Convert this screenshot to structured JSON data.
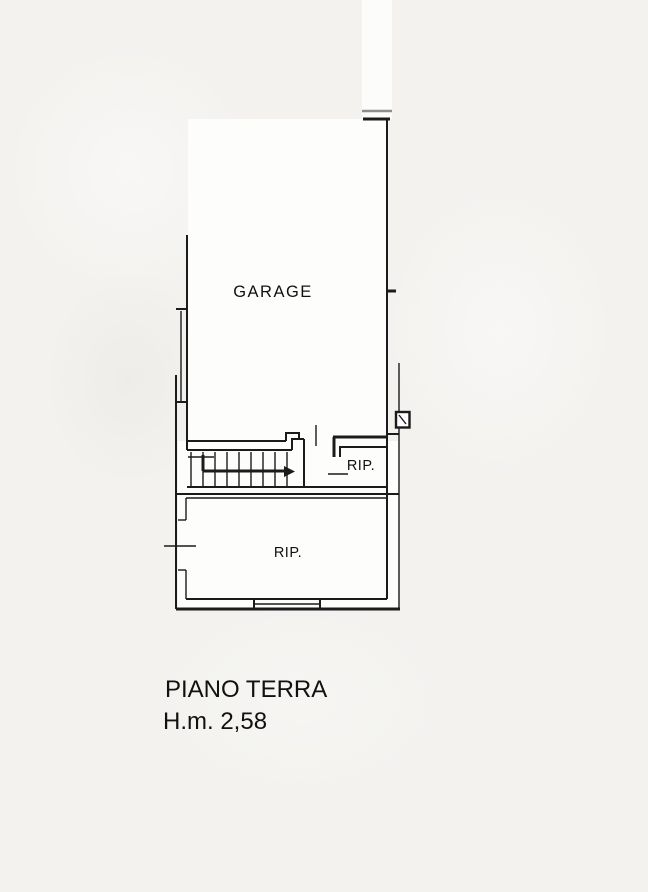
{
  "title_block": {
    "floor_name": "PIANO TERRA",
    "height_note": "H.m. 2,58"
  },
  "rooms": {
    "garage": {
      "label": "GARAGE"
    },
    "storage_upper": {
      "label": "RIP."
    },
    "storage_lower": {
      "label": "RIP."
    }
  },
  "symbols": [
    "stair-treads",
    "stair-direction-arrow",
    "window-right-wall",
    "window-bottom-wall",
    "door-opening-left-wall",
    "entry-cut-lines-top"
  ],
  "colors": {
    "line": "#1b1b1b",
    "entry_gray_line": "#8d8d8d",
    "background": "#f3f2ef",
    "plan_interior": "#fdfdfc"
  }
}
